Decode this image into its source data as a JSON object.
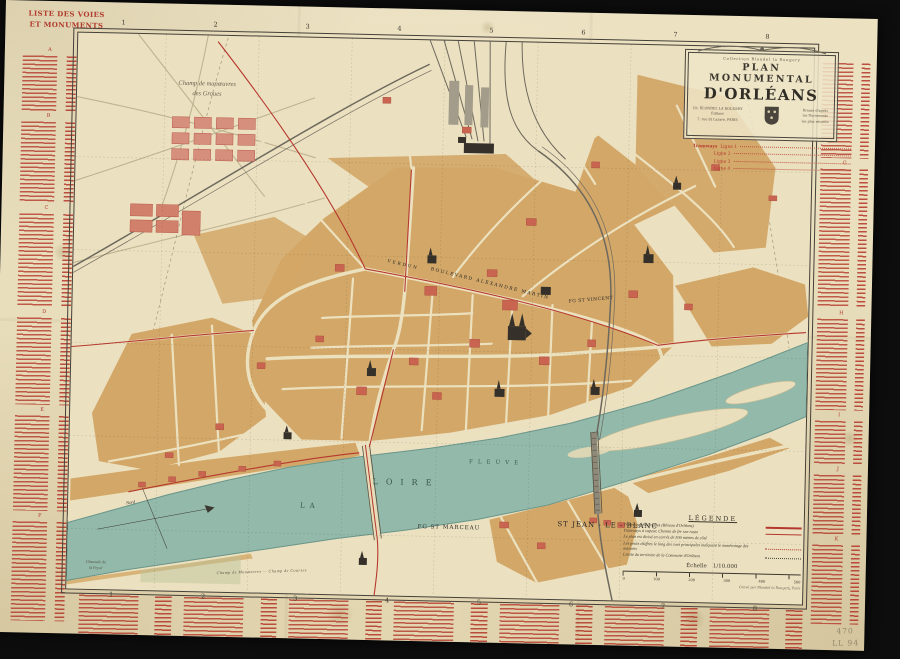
{
  "margin_index": {
    "title_line1": "LISTE DES VOIES",
    "title_line2": "ET MONUMENTS",
    "left_sections": [
      "A",
      "B",
      "C",
      "D",
      "E",
      "F"
    ],
    "right_sections": [
      "G",
      "H",
      "I",
      "J",
      "K"
    ]
  },
  "grid": {
    "columns": [
      "1",
      "2",
      "3",
      "4",
      "5",
      "6",
      "7",
      "8"
    ],
    "rows": [
      "A",
      "B",
      "C",
      "D",
      "E",
      "F"
    ]
  },
  "cartouche": {
    "collection": "Collection Blondel la Rougery",
    "title_line1": "PLAN MONUMENTAL",
    "title_line2": "D'ORLÉANS",
    "publisher_line1": "Ch. BLONDEL LA ROUGERY",
    "publisher_line2": "Éditeur",
    "publisher_line3": "7, rue St Lazare, PARIS",
    "notice_line1": "Dressé d'après",
    "notice_line2": "les Documents",
    "notice_line3": "les plus récents"
  },
  "tramways_note": {
    "heading": "Tramways",
    "lines": [
      "Ligne 1",
      "Ligne 2",
      "Ligne 3",
      "Ligne 4"
    ]
  },
  "map_labels": {
    "champ_manoeuvres_line1": "Champ de manœuvres",
    "champ_manoeuvres_line2": "des Groues",
    "verdun": "VERDUN",
    "boulevard_alexandre_martin": "BOULEVARD   ALEXANDRE   MARTIN",
    "fg_st_vincent": "FG ST VINCENT",
    "la": "LA",
    "loire": "LOIRE",
    "fleuve": "FLEUVE",
    "fg_st_marceau": "FG ST MARCEAU",
    "st_jean_le_blanc": "ST JEAN - LE - BLANC",
    "chaussee_line1": "Chaussée de",
    "chaussee_line2": "St Pryvé",
    "nord": "Nord",
    "champ_de_courses": "Champ de Manœuvres — Champ de Courses"
  },
  "legend": {
    "title": "LÉGENDE",
    "items": [
      {
        "label": "Tramways électriques (Réseau d'Orléans)",
        "symbol": "red-solid"
      },
      {
        "label": "Tramways à vapeur, Chemin de fer sur route",
        "symbol": "red-solid-thin"
      },
      {
        "label": "Le plan est divisé en carrés de 500 mètres de côté",
        "symbol": "none"
      },
      {
        "label": "Les petits chiffres le long des rues principales indiquent le numérotage des maisons",
        "symbol": "red-dotted"
      },
      {
        "label": "Limite du territoire de la Commune d'Orléans",
        "symbol": "black-dotted"
      }
    ],
    "scale_label": "Échelle",
    "scale_value": "1/10.000",
    "scale_ticks": [
      "0",
      "100",
      "200",
      "300",
      "400",
      "500"
    ],
    "credit": "Gravé par Blondel la Rougery, Paris"
  },
  "annotations": {
    "corner_number": "470",
    "corner_code": "LL 94"
  },
  "colors": {
    "paper": "#ebe1c1",
    "ink_red": "#b5382e",
    "river": "#92b9aa",
    "block_tan": "#d3a767",
    "monument_dark": "#35312a"
  }
}
